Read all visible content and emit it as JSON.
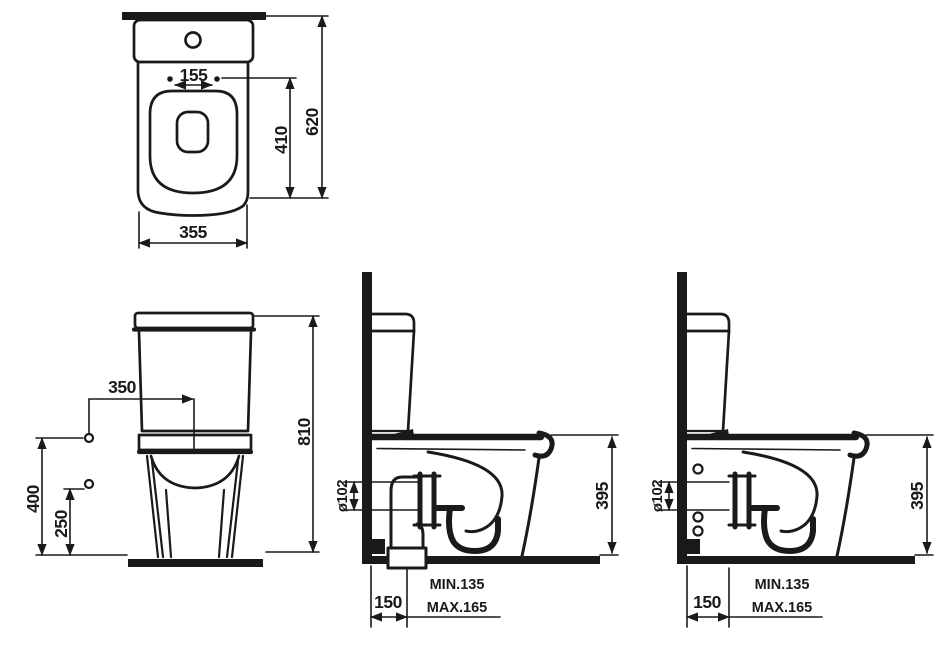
{
  "drawing": {
    "colors": {
      "ink": "#1a1a1a",
      "bg": "#ffffff"
    },
    "views": {
      "top": {
        "hinge_spacing": "155",
        "seat_depth": "410",
        "total_depth": "620",
        "width": "355"
      },
      "front": {
        "supply_offset": "350",
        "total_height": "810",
        "supply_height_upper": "400",
        "supply_height_lower": "250"
      },
      "side_floor_outlet": {
        "outlet_diameter": "ø102",
        "rim_height": "395",
        "outlet_wall_distance": "150",
        "outlet_min": "MIN.135",
        "outlet_max": "MAX.165"
      },
      "side_wall_outlet": {
        "outlet_diameter": "ø102",
        "rim_height": "395",
        "outlet_wall_distance": "150",
        "outlet_min": "MIN.135",
        "outlet_max": "MAX.165"
      }
    }
  }
}
